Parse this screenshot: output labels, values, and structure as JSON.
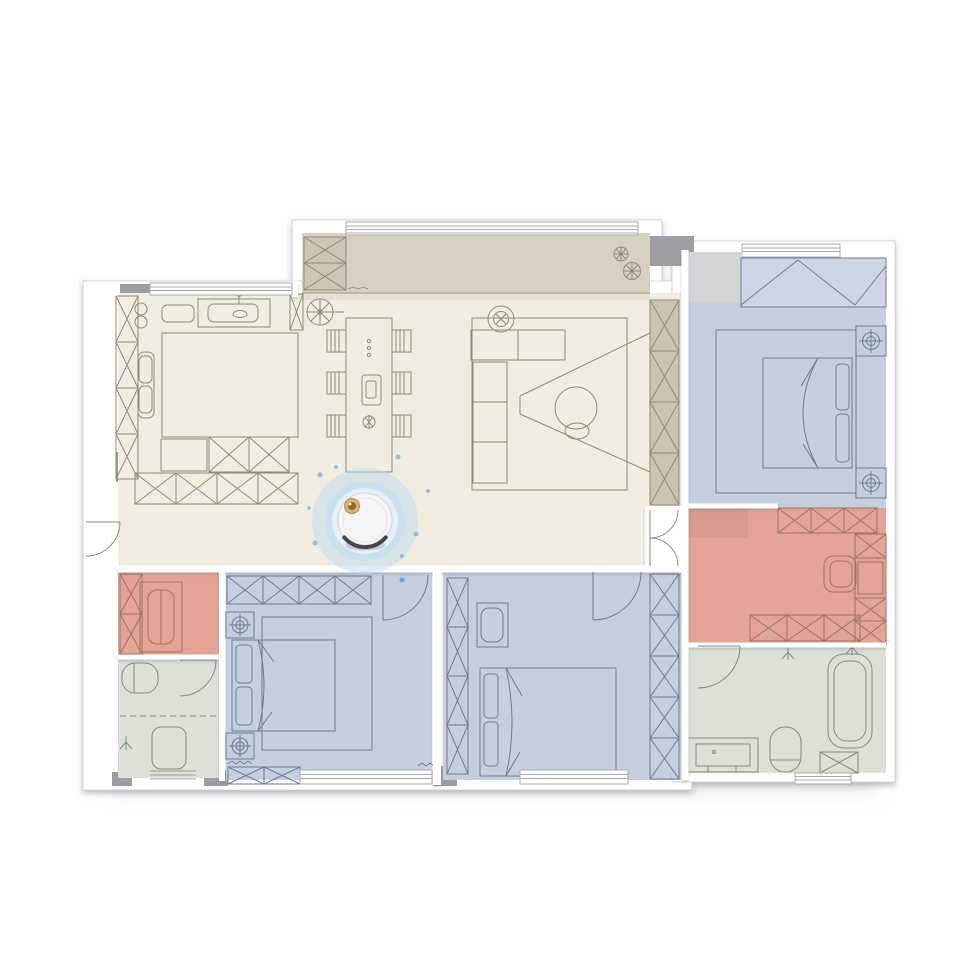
{
  "scene": {
    "title": "robot-vacuum-floor-plan-map",
    "background": "#ffffff",
    "plan_shadow": "#d8dadd"
  },
  "palette": {
    "wall": "#ffffff",
    "wall_edge": "#c9cbce",
    "pier": "#9b9fa3",
    "step_gray": "#d4d5d7",
    "cream": "#f1eee1",
    "tan": "#d9d0c3",
    "khaki": "#c9c5b2",
    "khaki_tan": "#cfc5b4",
    "blue": "#c5d0de",
    "blue_light": "#cdd7e3",
    "pink": "#e3a496",
    "bath": "#dce1d8",
    "line_warm": "#8d8a78",
    "line_cool": "#6d7b92",
    "line_bath": "#7e8a82",
    "line_pink": "#9c7261",
    "line_track": "#9a968a",
    "window_line": "#a9abae",
    "glow": "#bedcf0",
    "glow_core": "#e8f2fa",
    "glow_dot": "#66aede",
    "dot_bright": "#55a8ff",
    "robot_body": "#f7f5f6",
    "robot_edge": "#d8d4d6",
    "robot_ring": "#e8e5e6",
    "robot_bumper": "#45454a",
    "robot_button": "#d9b36a",
    "robot_button_rim": "#b08c4a",
    "robot_button_dark": "#8a6a33",
    "robot_button_hl": "#f5e7c8"
  },
  "rooms": [
    {
      "id": "balcony",
      "label": "Balcony",
      "color": "#d9d0c3"
    },
    {
      "id": "living-dining-kitchen",
      "label": "Living / Dining / Kitchen",
      "color": "#f1eee1"
    },
    {
      "id": "master-bedroom",
      "label": "Master Bedroom",
      "color": "#c5d0de"
    },
    {
      "id": "study",
      "label": "Study",
      "color": "#e3a496"
    },
    {
      "id": "master-bathroom",
      "label": "Master Bathroom",
      "color": "#dce1d8"
    },
    {
      "id": "dressing-room",
      "label": "Dressing Room",
      "color": "#e3a496"
    },
    {
      "id": "bathroom",
      "label": "Bathroom",
      "color": "#dce1d8"
    },
    {
      "id": "bedroom-left",
      "label": "Bedroom",
      "color": "#c5d0de"
    },
    {
      "id": "bedroom-middle",
      "label": "Bedroom",
      "color": "#c5d0de"
    }
  ],
  "robot": {
    "label": "robot-vacuum"
  }
}
